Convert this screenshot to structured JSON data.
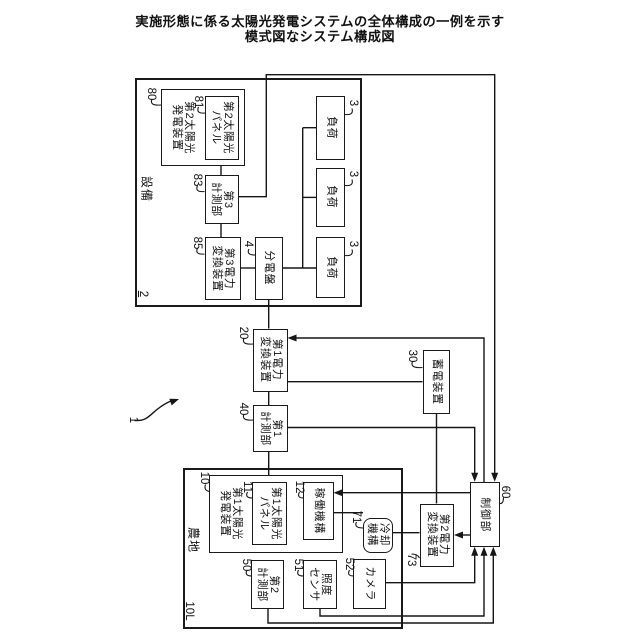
{
  "title": {
    "line1": "実施形態に係る太陽光発電システムの全体構成の一例を示す",
    "line2": "模式図なシステム構成図"
  },
  "system": {
    "ref": "1"
  },
  "equipment": {
    "label": "設備",
    "ref": "2",
    "pv2": {
      "label": "第2太陽光\n発電装置",
      "ref": "80"
    },
    "panel2": {
      "label": "第2太陽光\nパネル",
      "ref": "81"
    },
    "meter3": {
      "label": "第3\n計測部",
      "ref": "83"
    },
    "conv3": {
      "label": "第3電力\n変換装置",
      "ref": "85"
    },
    "distboard": {
      "label": "分電盤",
      "ref": "4"
    },
    "loads": [
      {
        "label": "負荷",
        "ref": "3"
      },
      {
        "label": "負荷",
        "ref": "3"
      },
      {
        "label": "負荷",
        "ref": "3"
      }
    ]
  },
  "core": {
    "conv1": {
      "label": "第1電力\n変換装置",
      "ref": "20"
    },
    "battery": {
      "label": "蓄電装置",
      "ref": "30"
    },
    "meter1": {
      "label": "第1\n計測部",
      "ref": "40"
    },
    "controller": {
      "label": "制御部",
      "ref": "60"
    },
    "conv2": {
      "label": "第2電力\n変換装置",
      "ref": "73"
    }
  },
  "farmland": {
    "label": "農地",
    "ref": "10L",
    "pv1": {
      "label": "第1太陽光\n発電装置",
      "ref": "10"
    },
    "panel1": {
      "label": "第1太陽光\nパネル",
      "ref": "11"
    },
    "drive": {
      "label": "稼働機構",
      "ref": "12"
    },
    "cooling": {
      "label": "冷却\n機構",
      "ref": "71"
    },
    "meter2": {
      "label": "第2\n計測部",
      "ref": "50"
    },
    "lightsensor": {
      "label": "照度\nセンサ",
      "ref": "51"
    },
    "camera": {
      "label": "カメラ",
      "ref": "52"
    }
  }
}
